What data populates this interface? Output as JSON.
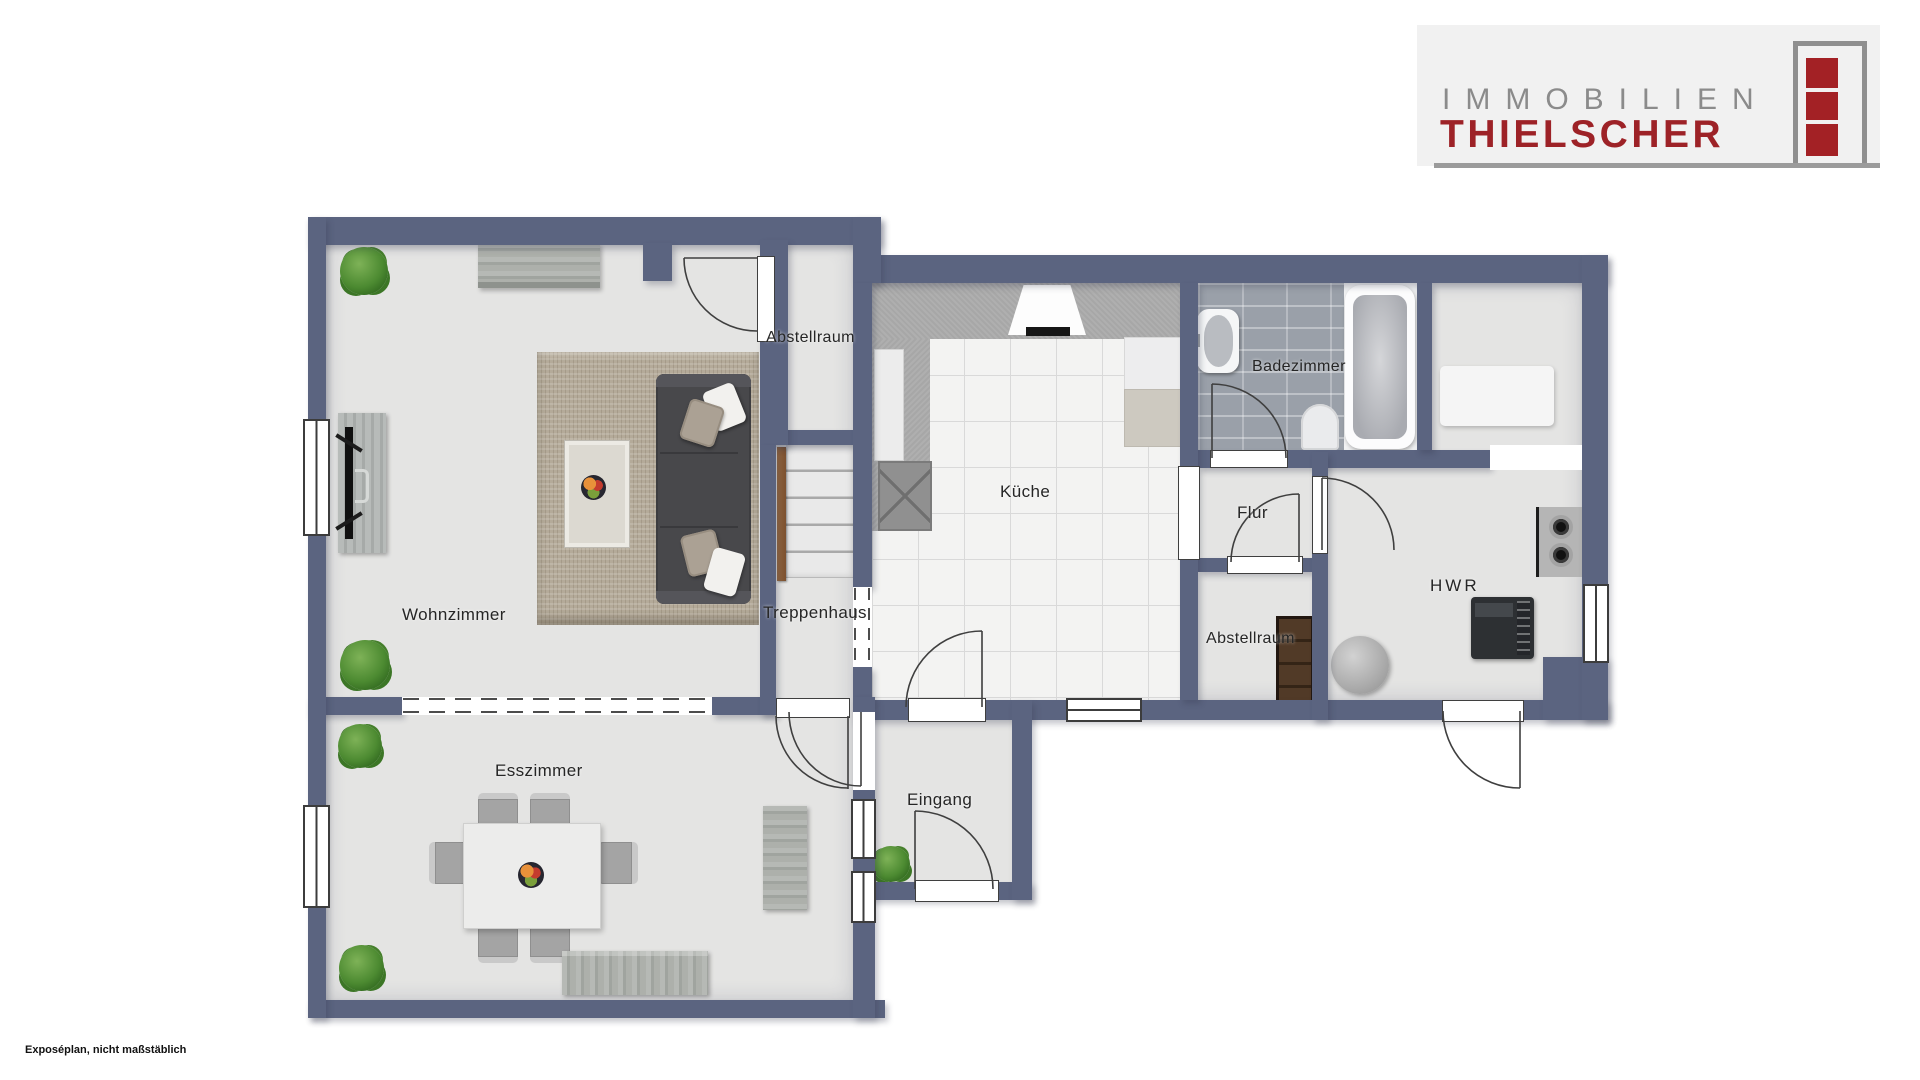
{
  "header_logo": {
    "brand_top": "IMMOBILIEN",
    "brand_bottom": "THIELSCHER",
    "brand_top_color": "#8b8b8b",
    "brand_bottom_color": "#9d2227",
    "icon_red": "#a32125",
    "panel_bg": "#f1f1f1"
  },
  "footer": {
    "disclaimer": "Exposéplan, nicht maßstäblich"
  },
  "floorplan": {
    "wall_color": "#5b6480",
    "floor_color": "#e4e4e3",
    "kitchen_tile_color": "#f3f3f2",
    "bath_tile_color": "#9aa0a9",
    "rug_color": "#b4aa99",
    "handrail_color": "#8a5c39",
    "rooms": [
      {
        "id": "wohnzimmer",
        "label": "Wohnzimmer"
      },
      {
        "id": "abstellraum-oben",
        "label": "Abstellraum"
      },
      {
        "id": "treppenhaus",
        "label": "Treppenhaus"
      },
      {
        "id": "kueche",
        "label": "Küche"
      },
      {
        "id": "badezimmer",
        "label": "Badezimmer"
      },
      {
        "id": "flur",
        "label": "Flur"
      },
      {
        "id": "abstellraum-unten",
        "label": "Abstellraum"
      },
      {
        "id": "hwr",
        "label": "HWR"
      },
      {
        "id": "esszimmer",
        "label": "Esszimmer"
      },
      {
        "id": "eingang",
        "label": "Eingang"
      }
    ]
  }
}
